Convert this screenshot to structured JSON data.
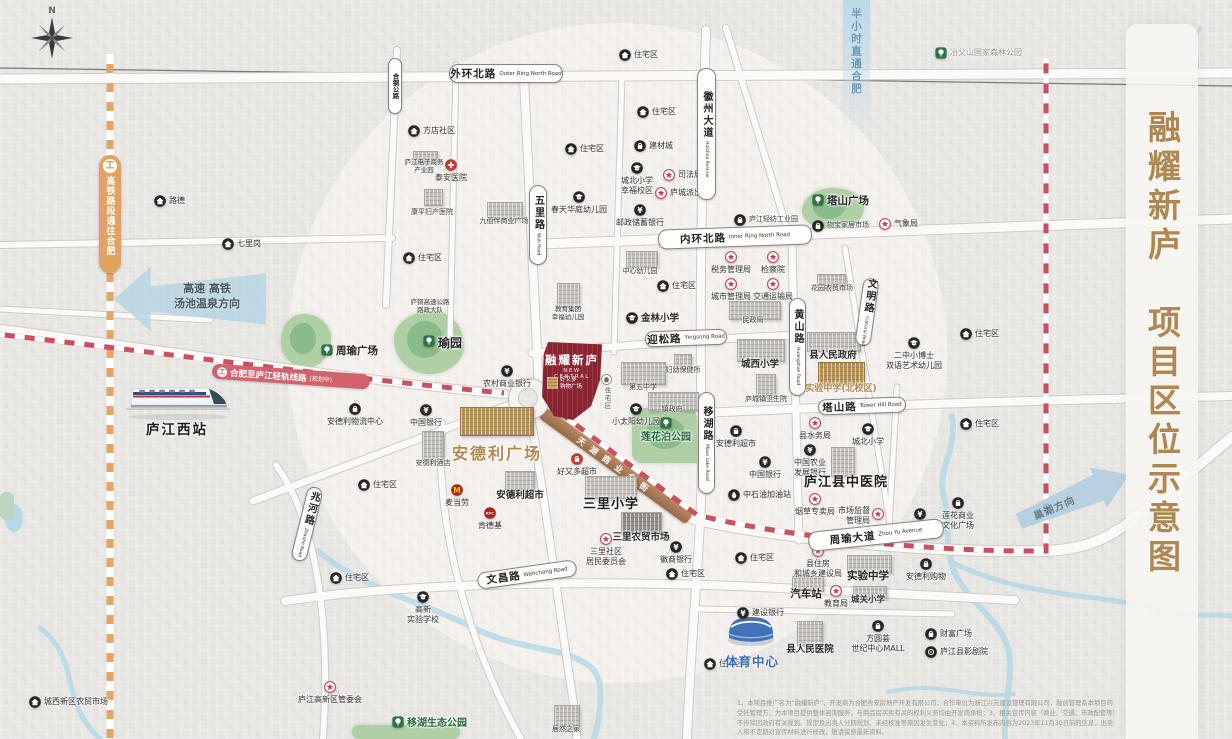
{
  "title": {
    "text": "融耀新庐　项目区位示意图"
  },
  "compass": {
    "north": "N"
  },
  "station": {
    "label": "庐江西站"
  },
  "project": {
    "name": "融耀新庐",
    "name_en": "NEW CENTRAL",
    "mall": "好又多\n购物广场",
    "residential": "住宅区"
  },
  "transit": {
    "hsr_line": "高铁路段通往合肥",
    "light_rail": "合肥至庐江轻轨线路",
    "light_rail_status": "(规划中)",
    "golden_street": "天湖商业金街"
  },
  "arrows": {
    "west_line1": "高速 高铁",
    "west_line2": "汤池温泉方向",
    "north": "半小时直通合肥",
    "east": "巢湖方向"
  },
  "sports_center": {
    "label": "体育中心"
  },
  "disclaimer": "1、本项目推广名为“融耀新庐”，开发商为合肥秀安房地产开发有限公司；合作单位为浙江兴元建设管理有限公司，融创管理系本项目的受托管理方，为本项目提供整体咨询服务，与商品房买卖有关的权利义务均由开发商承担；3、相关宣传内容（商业、交通、市政配套等）不排除因政府有关规划、规定及出卖人分期规划、未经核准等原因发生变化；4、本资料所发布内容为2023年11月30日前的信息，出卖人将不定期对宣传材料进行修改，敬请留意最新资料。",
  "road_labels": [
    {
      "cn": "外环北路",
      "en": "Outer Ring North Road",
      "x": 449,
      "y": 64,
      "w": 112,
      "h": 17
    },
    {
      "cn": "内环北路",
      "en": "Inner Ring North Road",
      "x": 658,
      "y": 227,
      "w": 152,
      "h": 18,
      "rot": -2
    },
    {
      "cn": "迎松路",
      "en": "Yingsong Road",
      "x": 645,
      "y": 330,
      "w": 80,
      "h": 14,
      "rot": -2
    },
    {
      "cn": "塔山路",
      "en": "Tower Hill Road",
      "x": 818,
      "y": 398,
      "w": 86,
      "h": 14,
      "rot": -2
    },
    {
      "cn": "周瑜大道",
      "en": "Zhou Yu Avenue",
      "x": 808,
      "y": 525,
      "w": 134,
      "h": 18,
      "rot": -6
    },
    {
      "cn": "文昌路",
      "en": "Wenchang Road",
      "x": 477,
      "y": 566,
      "w": 98,
      "h": 15,
      "rot": -8
    },
    {
      "cn": "五里路",
      "en": "Wuli Road",
      "x": 529,
      "y": 185,
      "w": 16,
      "h": 78,
      "vert": 1
    },
    {
      "cn": "徽州大道",
      "en": "Huizhou Avenue",
      "x": 697,
      "y": 68,
      "w": 17,
      "h": 130,
      "vert": 1
    },
    {
      "cn": "黄山路",
      "en": "Huangshan Road",
      "x": 789,
      "y": 298,
      "w": 15,
      "h": 96,
      "vert": 1
    },
    {
      "cn": "文明路",
      "en": "Cultural Road",
      "x": 859,
      "y": 278,
      "w": 14,
      "h": 66,
      "vert": 1,
      "rot": 8
    },
    {
      "cn": "移湖路",
      "en": "Move Lake Road",
      "x": 698,
      "y": 392,
      "w": 15,
      "h": 100,
      "vert": 1
    },
    {
      "cn": "兆河路",
      "en": "Zhaohe Road",
      "x": 299,
      "y": 486,
      "w": 14,
      "h": 74,
      "vert": 1,
      "rot": 14
    },
    {
      "cn": "合铜公路",
      "en": "",
      "x": 388,
      "y": 58,
      "w": 12,
      "h": 54,
      "vert": 1,
      "small": 1
    }
  ],
  "pois": [
    {
      "t": "路德",
      "x": 160,
      "y": 201,
      "i": "house",
      "p": "r"
    },
    {
      "t": "七里岗",
      "x": 228,
      "y": 244,
      "i": "house",
      "p": "r"
    },
    {
      "t": "方店社区",
      "x": 414,
      "y": 131,
      "i": "house",
      "p": "r"
    },
    {
      "t": "庐江电子商务\n产业园",
      "x": 424,
      "y": 163,
      "i": "none",
      "c": "t"
    },
    {
      "t": "泰安医院",
      "x": 451,
      "y": 165,
      "i": "cross",
      "p": "b"
    },
    {
      "t": "康平妇产医院",
      "x": 432,
      "y": 213,
      "i": "none",
      "c": "s"
    },
    {
      "t": "九佰伴商业广场",
      "x": 504,
      "y": 222,
      "i": "none",
      "c": "s"
    },
    {
      "t": "春天华庭幼儿园",
      "x": 579,
      "y": 197,
      "i": "school",
      "p": "b"
    },
    {
      "t": "教育集团\n幸福幼儿园",
      "x": 568,
      "y": 310,
      "i": "none",
      "c": "t"
    },
    {
      "t": "住宅区",
      "x": 625,
      "y": 55,
      "i": "house",
      "p": "r"
    },
    {
      "t": "住宅区",
      "x": 571,
      "y": 149,
      "i": "house",
      "p": "r"
    },
    {
      "t": "住宅区",
      "x": 643,
      "y": 112,
      "i": "house",
      "p": "r"
    },
    {
      "t": "住宅区",
      "x": 409,
      "y": 258,
      "i": "house",
      "p": "r"
    },
    {
      "t": "建材城",
      "x": 640,
      "y": 146,
      "i": "shop",
      "p": "r"
    },
    {
      "t": "城北小学\n幸福校区",
      "x": 637,
      "y": 168,
      "i": "school",
      "p": "b"
    },
    {
      "t": "司法局",
      "x": 669,
      "y": 175,
      "i": "star",
      "p": "r"
    },
    {
      "t": "庐城派出所",
      "x": 661,
      "y": 193,
      "i": "star",
      "p": "r"
    },
    {
      "t": "邮政储蓄银行",
      "x": 640,
      "y": 210,
      "i": "bank",
      "p": "b"
    },
    {
      "t": "庐江轻纺工业园",
      "x": 740,
      "y": 220,
      "i": "shop",
      "p": "r",
      "c": "s"
    },
    {
      "t": "塔山广场",
      "x": 818,
      "y": 200,
      "i": "tree",
      "p": "r",
      "c": "bold"
    },
    {
      "t": "物宝家居市场",
      "x": 818,
      "y": 226,
      "i": "shop",
      "p": "r",
      "c": "s"
    },
    {
      "t": "气象局",
      "x": 885,
      "y": 224,
      "i": "star",
      "p": "r"
    },
    {
      "t": "冶父山国家森林公园",
      "x": 941,
      "y": 53,
      "i": "tree",
      "p": "r",
      "c": "muted"
    },
    {
      "t": "住宅区",
      "x": 966,
      "y": 334,
      "i": "house",
      "p": "r"
    },
    {
      "t": "住宅区",
      "x": 966,
      "y": 424,
      "i": "house",
      "p": "r"
    },
    {
      "t": "二中小博士\n双语艺术幼儿园",
      "x": 914,
      "y": 343,
      "i": "school",
      "p": "b"
    },
    {
      "t": "中心幼儿园",
      "x": 640,
      "y": 272,
      "i": "none",
      "c": "s"
    },
    {
      "t": "住宅区",
      "x": 663,
      "y": 286,
      "i": "house",
      "p": "r"
    },
    {
      "t": "金林小学",
      "x": 632,
      "y": 318,
      "i": "school",
      "p": "r",
      "c": "semibold"
    },
    {
      "t": "税务管理局",
      "x": 731,
      "y": 257,
      "i": "star",
      "p": "b"
    },
    {
      "t": "检察院",
      "x": 773,
      "y": 257,
      "i": "star",
      "p": "b"
    },
    {
      "t": "城市管理局",
      "x": 731,
      "y": 284,
      "i": "star",
      "p": "b"
    },
    {
      "t": "交通运输局",
      "x": 773,
      "y": 284,
      "i": "star",
      "p": "b"
    },
    {
      "t": "民政局",
      "x": 753,
      "y": 321,
      "i": "none",
      "c": "s"
    },
    {
      "t": "花园农贸市场",
      "x": 832,
      "y": 289,
      "i": "none",
      "c": "s"
    },
    {
      "t": "城西小学",
      "x": 760,
      "y": 364,
      "i": "none",
      "c": "semibold"
    },
    {
      "t": "县人民政府",
      "x": 833,
      "y": 355,
      "i": "none",
      "c": "semibold"
    },
    {
      "t": "实验中学(北校区)",
      "x": 841,
      "y": 389,
      "i": "none",
      "c": "gold-s"
    },
    {
      "t": "庐城镇卫生院",
      "x": 766,
      "y": 400,
      "i": "none",
      "c": "s"
    },
    {
      "t": "妇幼保健所",
      "x": 683,
      "y": 371,
      "i": "none",
      "c": "s"
    },
    {
      "t": "第五中学",
      "x": 643,
      "y": 388,
      "i": "none",
      "c": "s"
    },
    {
      "t": "镇政府",
      "x": 672,
      "y": 410,
      "i": "none",
      "c": "s"
    },
    {
      "t": "小太阳幼儿园",
      "x": 636,
      "y": 409,
      "i": "school",
      "p": "b"
    },
    {
      "t": "莲花泊公园",
      "x": 666,
      "y": 423,
      "i": "tree",
      "p": "b",
      "c": "park"
    },
    {
      "t": "县水务局",
      "x": 815,
      "y": 423,
      "i": "star",
      "p": "b"
    },
    {
      "t": "城北小学",
      "x": 868,
      "y": 429,
      "i": "school",
      "p": "b"
    },
    {
      "t": "中国农业\n发展银行",
      "x": 810,
      "y": 450,
      "i": "bank",
      "p": "b"
    },
    {
      "t": "庐江县中医院",
      "x": 846,
      "y": 480,
      "i": "none",
      "c": "big"
    },
    {
      "t": "烟草专卖局",
      "x": 815,
      "y": 499,
      "i": "star",
      "p": "b"
    },
    {
      "t": "市场监督\n管理局",
      "x": 878,
      "y": 514,
      "i": "star",
      "p": "l"
    },
    {
      "t": "建设银行",
      "x": 920,
      "y": 514,
      "i": "bank",
      "p": "b"
    },
    {
      "t": "莲花商业\n文化广场",
      "x": 958,
      "y": 503,
      "i": "shop",
      "p": "b"
    },
    {
      "t": "安德利超市",
      "x": 736,
      "y": 431,
      "i": "shop",
      "p": "b"
    },
    {
      "t": "中国银行",
      "x": 765,
      "y": 462,
      "i": "bank",
      "p": "b"
    },
    {
      "t": "中石油加油站",
      "x": 734,
      "y": 495,
      "i": "gas",
      "p": "r"
    },
    {
      "t": "农村商业银行",
      "x": 507,
      "y": 371,
      "i": "bank",
      "p": "b"
    },
    {
      "t": "庐铜高速公路\n路政大队",
      "x": 430,
      "y": 303,
      "i": "none",
      "c": "t"
    },
    {
      "t": "周瑜广场",
      "x": 327,
      "y": 350,
      "i": "tree",
      "p": "r",
      "c": "bold"
    },
    {
      "t": "瑜园",
      "x": 429,
      "y": 341,
      "i": "tree",
      "p": "r",
      "c": "bold2"
    },
    {
      "t": "安德利物流中心",
      "x": 355,
      "y": 409,
      "i": "shop",
      "p": "b"
    },
    {
      "t": "中国银行",
      "x": 426,
      "y": 410,
      "i": "bank",
      "p": "b"
    },
    {
      "t": "安德利酒店",
      "x": 433,
      "y": 464,
      "i": "none",
      "c": "s"
    },
    {
      "t": "安德利广场",
      "x": 497,
      "y": 449,
      "i": "none",
      "c": "gold-big"
    },
    {
      "t": "安德利超市",
      "x": 520,
      "y": 495,
      "i": "none",
      "c": "semibold"
    },
    {
      "t": "麦当劳",
      "x": 457,
      "y": 490,
      "i": "m",
      "p": "b"
    },
    {
      "t": "肯德基",
      "x": 490,
      "y": 513,
      "i": "kfc",
      "p": "b"
    },
    {
      "t": "好又多超市",
      "x": 577,
      "y": 459,
      "i": "redshop",
      "p": "b"
    },
    {
      "t": "三里小学",
      "x": 611,
      "y": 502,
      "i": "none",
      "c": "big"
    },
    {
      "t": "三里农贸市场",
      "x": 641,
      "y": 537,
      "i": "none",
      "c": "semibold"
    },
    {
      "t": "三里社区\n居民委员会",
      "x": 606,
      "y": 539,
      "i": "star",
      "p": "b"
    },
    {
      "t": "徽商银行",
      "x": 676,
      "y": 547,
      "i": "bank",
      "p": "b"
    },
    {
      "t": "住宅区",
      "x": 741,
      "y": 558,
      "i": "house",
      "p": "r"
    },
    {
      "t": "住宅区",
      "x": 672,
      "y": 574,
      "i": "house",
      "p": "r"
    },
    {
      "t": "住宅区",
      "x": 710,
      "y": 664,
      "i": "house",
      "p": "r"
    },
    {
      "t": "住宅区",
      "x": 364,
      "y": 485,
      "i": "house",
      "p": "r"
    },
    {
      "t": "住宅区",
      "x": 336,
      "y": 578,
      "i": "house",
      "p": "r"
    },
    {
      "t": "建设银行",
      "x": 743,
      "y": 613,
      "i": "bank",
      "p": "r"
    },
    {
      "t": "县人民医院",
      "x": 810,
      "y": 649,
      "i": "none",
      "c": "semibold"
    },
    {
      "t": "方圆荟\n世纪中心MALL",
      "x": 878,
      "y": 626,
      "i": "shop",
      "p": "b"
    },
    {
      "t": "县住房\n和城乡建设局",
      "x": 818,
      "y": 551,
      "i": "star",
      "p": "b"
    },
    {
      "t": "实验中学",
      "x": 868,
      "y": 575,
      "i": "none",
      "c": "bold"
    },
    {
      "t": "汽车站",
      "x": 806,
      "y": 593,
      "i": "none",
      "c": "bold"
    },
    {
      "t": "教育局",
      "x": 836,
      "y": 591,
      "i": "star",
      "p": "b"
    },
    {
      "t": "城关小学",
      "x": 868,
      "y": 600,
      "i": "none",
      "c": "semibold-s"
    },
    {
      "t": "安德利购物",
      "x": 926,
      "y": 564,
      "i": "shop",
      "p": "b"
    },
    {
      "t": "财富广场",
      "x": 931,
      "y": 634,
      "i": "shop",
      "p": "r"
    },
    {
      "t": "庐江县影剧院",
      "x": 931,
      "y": 652,
      "i": "film",
      "p": "r"
    },
    {
      "t": "高新\n实验学校",
      "x": 423,
      "y": 597,
      "i": "school",
      "p": "b"
    },
    {
      "t": "庐江高新区管委会",
      "x": 330,
      "y": 687,
      "i": "star",
      "p": "b"
    },
    {
      "t": "移湖生态公园",
      "x": 398,
      "y": 722,
      "i": "tree",
      "p": "r",
      "c": "park"
    },
    {
      "t": "居然之家",
      "x": 566,
      "y": 730,
      "i": "none",
      "c": "s"
    },
    {
      "t": "城西新区农贸市场",
      "x": 35,
      "y": 702,
      "i": "house",
      "p": "r"
    },
    {
      "t": "庐江西站",
      "x": 177,
      "y": 427,
      "i": "none",
      "c": "station"
    }
  ],
  "buildings": [
    {
      "x": 413,
      "y": 151,
      "w": 23,
      "h": 11
    },
    {
      "x": 424,
      "y": 189,
      "w": 17,
      "h": 15
    },
    {
      "x": 487,
      "y": 202,
      "w": 34,
      "h": 16
    },
    {
      "x": 557,
      "y": 283,
      "w": 21,
      "h": 23
    },
    {
      "x": 626,
      "y": 251,
      "w": 30,
      "h": 15
    },
    {
      "x": 729,
      "y": 301,
      "w": 50,
      "h": 17
    },
    {
      "x": 817,
      "y": 274,
      "w": 27,
      "h": 13
    },
    {
      "x": 737,
      "y": 339,
      "w": 46,
      "h": 21
    },
    {
      "x": 807,
      "y": 332,
      "w": 52,
      "h": 18
    },
    {
      "x": 818,
      "y": 362,
      "w": 45,
      "h": 21,
      "v": "gold"
    },
    {
      "x": 756,
      "y": 374,
      "w": 18,
      "h": 23
    },
    {
      "x": 674,
      "y": 354,
      "w": 16,
      "h": 13
    },
    {
      "x": 621,
      "y": 362,
      "w": 43,
      "h": 21
    },
    {
      "x": 648,
      "y": 392,
      "w": 49,
      "h": 17
    },
    {
      "x": 831,
      "y": 447,
      "w": 22,
      "h": 28
    },
    {
      "x": 847,
      "y": 555,
      "w": 43,
      "h": 16
    },
    {
      "x": 792,
      "y": 576,
      "w": 30,
      "h": 14
    },
    {
      "x": 853,
      "y": 586,
      "w": 32,
      "h": 11
    },
    {
      "x": 797,
      "y": 621,
      "w": 24,
      "h": 23
    },
    {
      "x": 621,
      "y": 512,
      "w": 39,
      "h": 21,
      "v": "dark"
    },
    {
      "x": 585,
      "y": 476,
      "w": 50,
      "h": 21
    },
    {
      "x": 460,
      "y": 407,
      "w": 72,
      "h": 27,
      "v": "gold"
    },
    {
      "x": 422,
      "y": 431,
      "w": 20,
      "h": 29
    },
    {
      "x": 505,
      "y": 471,
      "w": 28,
      "h": 17
    },
    {
      "x": 554,
      "y": 705,
      "w": 24,
      "h": 23
    }
  ],
  "parks": [
    {
      "x": 281,
      "y": 314,
      "w": 50,
      "h": 54,
      "r": "45% 55% 50% 50% / 50% 45% 55% 50%"
    },
    {
      "x": 394,
      "y": 311,
      "w": 70,
      "h": 63,
      "r": "55% 45% 50% 50% / 45% 55% 45% 55%"
    },
    {
      "x": 802,
      "y": 188,
      "w": 62,
      "h": 42,
      "r": "50% 50% 45% 55% / 55% 45% 55% 45%"
    },
    {
      "x": 632,
      "y": 408,
      "w": 75,
      "h": 55,
      "r": "10px"
    },
    {
      "x": 352,
      "y": 725,
      "w": 108,
      "h": 14,
      "r": "7px"
    }
  ]
}
